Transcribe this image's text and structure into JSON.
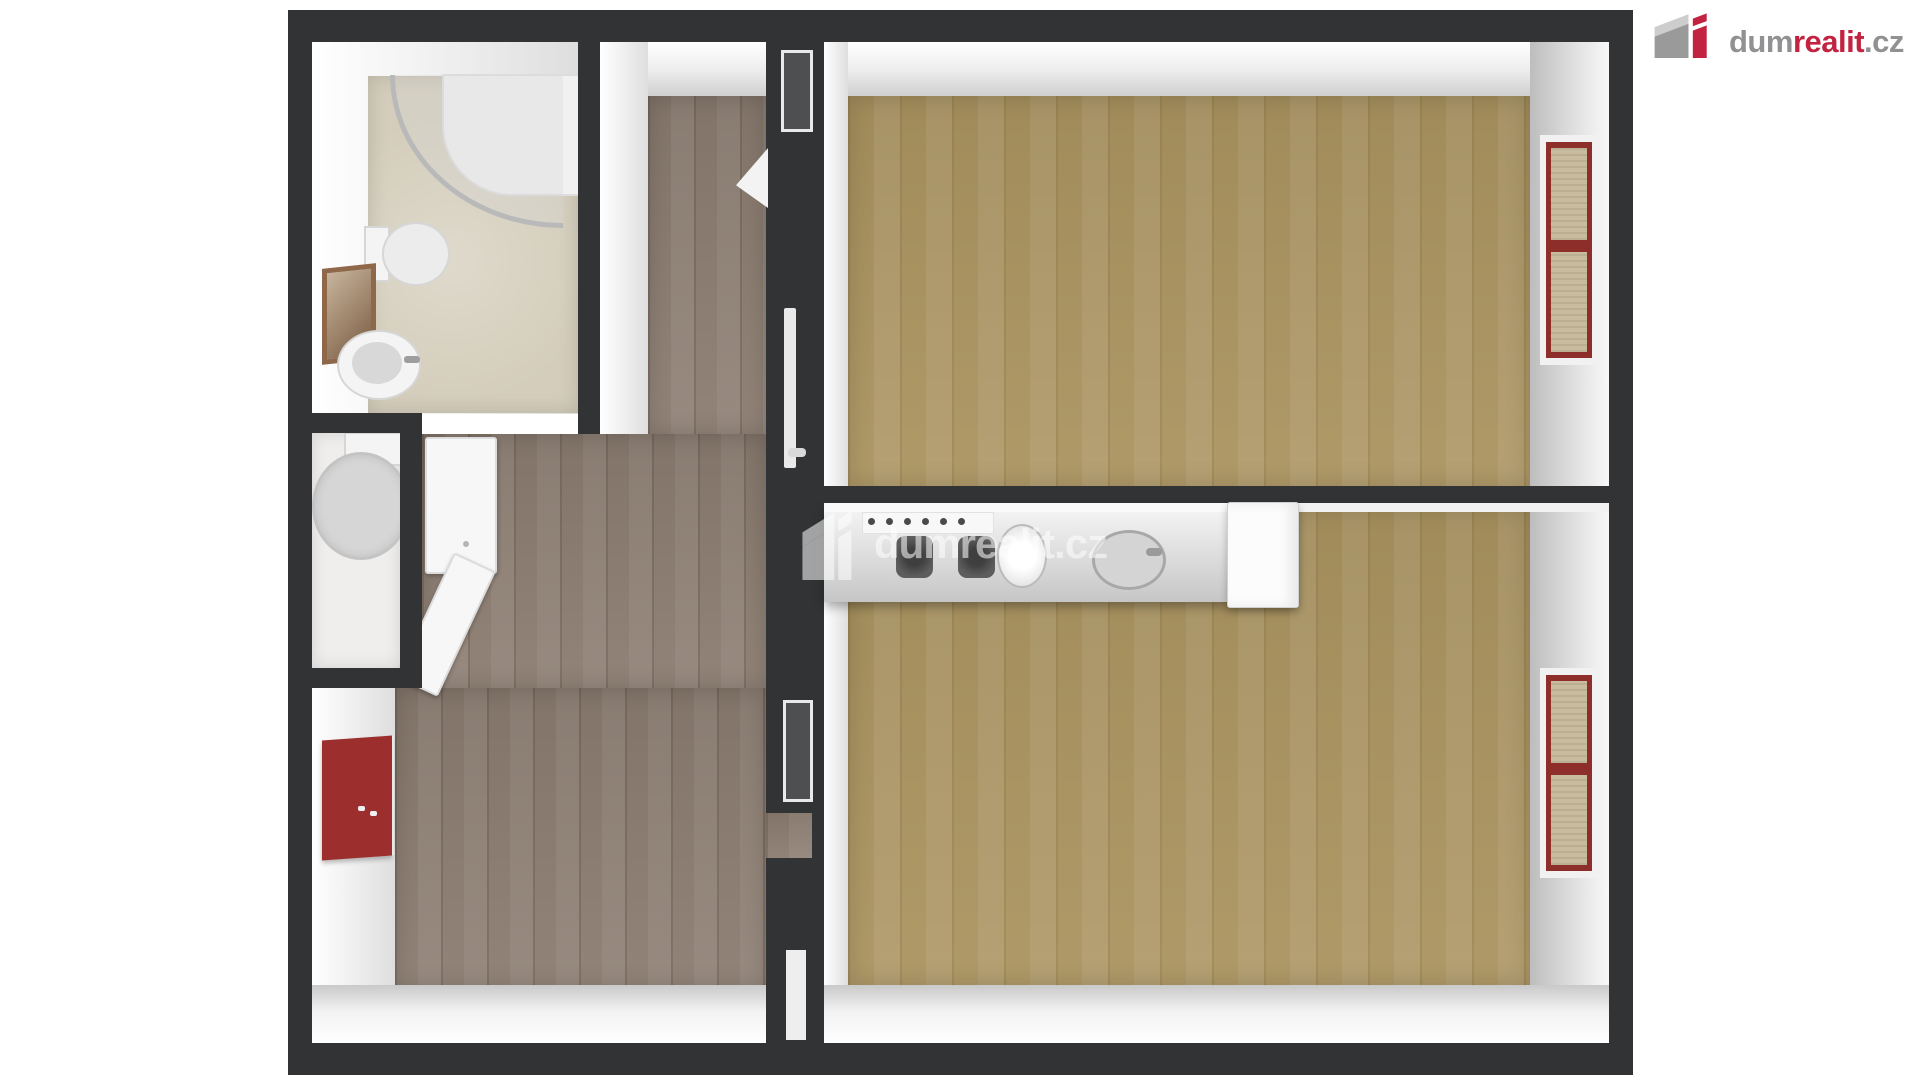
{
  "brand": {
    "logo_text": {
      "dum": "dum",
      "realit": "realit",
      "cz": ".cz"
    },
    "colors": {
      "red": "#c22340",
      "gray": "#919193"
    }
  },
  "watermark": {
    "dum": "dum",
    "realit": "realit",
    "cz": ".cz",
    "color": "#ffffff",
    "opacity": 0.55
  },
  "floorplan": {
    "colors": {
      "wall_dark": "#313335",
      "wall_face_white": "#f3f3f3",
      "hall_floor_wood": "#8d7e72",
      "room_floor_tan": "#ab9460",
      "bathroom_tile": "#d4cdbb",
      "window_frame_red": "#8e2e2a",
      "accent_panel_red": "#9c2f2e"
    }
  }
}
